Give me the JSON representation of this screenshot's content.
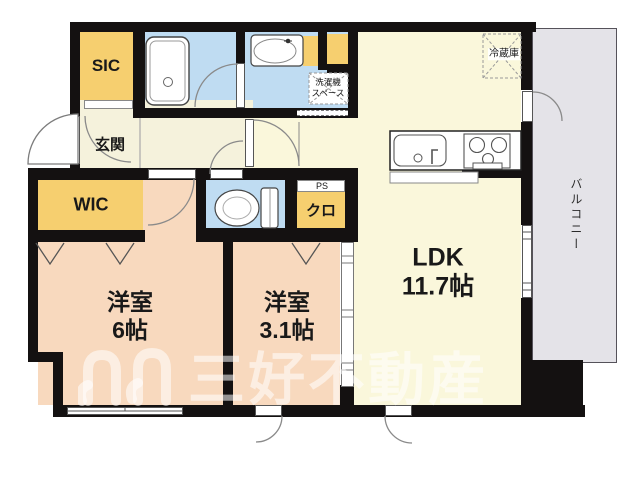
{
  "rooms": {
    "sic": "SIC",
    "genkan": "玄関",
    "wic": "WIC",
    "bedroom1": {
      "name": "洋室",
      "size": "6帖"
    },
    "bedroom2": {
      "name": "洋室",
      "size": "3.1帖"
    },
    "ldk": {
      "name": "LDK",
      "size": "11.7帖"
    },
    "closet": "クロ",
    "ps": "PS",
    "balcony": "バルコニー"
  },
  "fixtures": {
    "fridge": "冷蔵庫",
    "washer_line1": "洗濯機",
    "washer_line2": "スペース"
  },
  "watermark": {
    "text": "三好不動産"
  },
  "colors": {
    "wall": "#141111",
    "room_yellow": "#F6CF6F",
    "room_pink": "#F8D9BE",
    "room_blue": "#BFDCF2",
    "room_cream": "#FAF7DB",
    "hall_cream": "#F5F2DC",
    "balcony_gray": "#E4E3E8"
  }
}
